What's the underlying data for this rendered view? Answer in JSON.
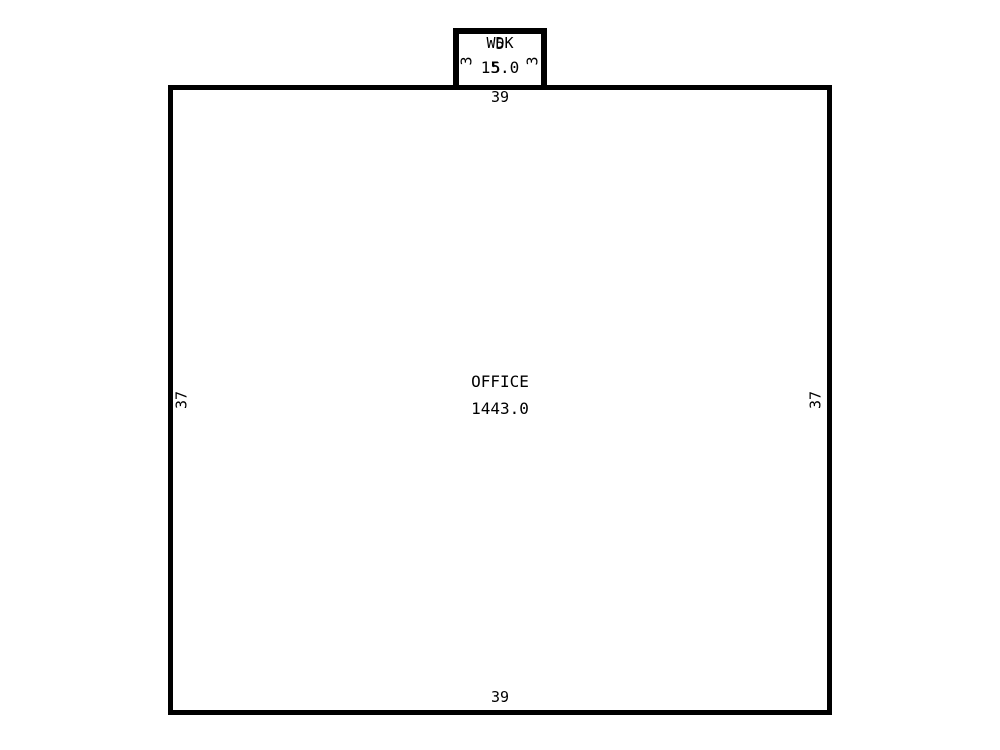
{
  "rooms": {
    "office": {
      "name": "OFFICE",
      "area": "1443.0",
      "dims": {
        "top": "39",
        "bottom": "39",
        "left": "37",
        "right": "37"
      }
    },
    "annex": {
      "name": "WDK",
      "area": "15.0",
      "dims": {
        "top": "5",
        "bottom": "5",
        "left": "3",
        "right": "3"
      }
    }
  }
}
